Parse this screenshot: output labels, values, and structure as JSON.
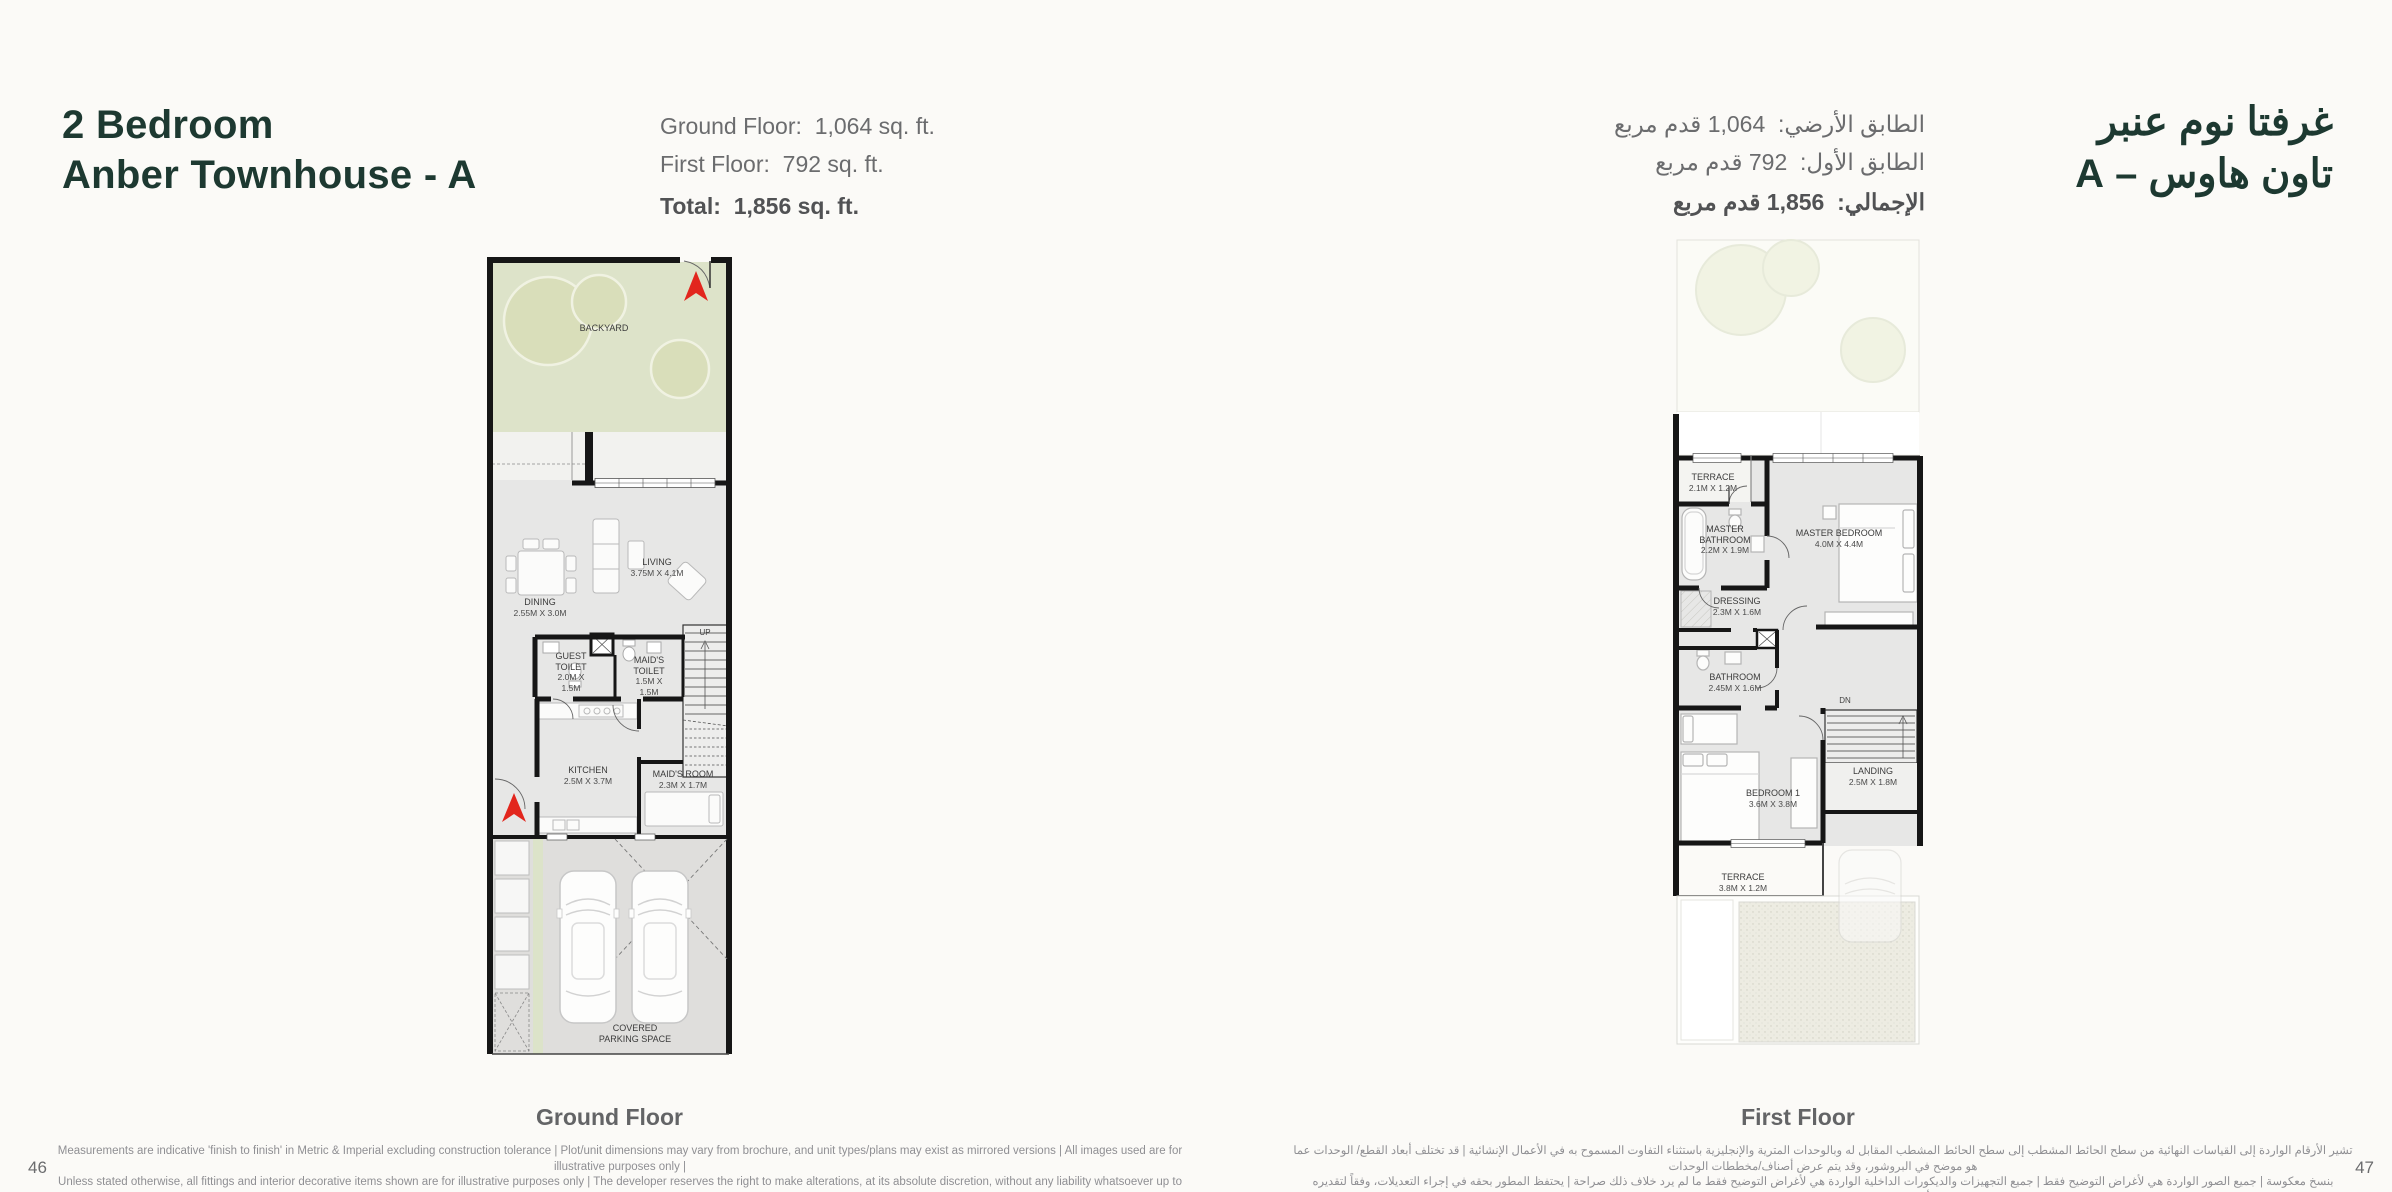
{
  "page": {
    "title_en_line1": "2 Bedroom",
    "title_en_line2": "Anber Townhouse - A",
    "title_ar_line1": "غرفتا نوم عنبر",
    "title_ar_line2": "تاون هاوس – A",
    "page_number_left": "46",
    "page_number_right": "47"
  },
  "stats_en": [
    {
      "label": "Ground Floor:",
      "value": "1,064 sq. ft."
    },
    {
      "label": "First Floor:",
      "value": "792 sq. ft."
    },
    {
      "label": "Total:",
      "value": "1,856  sq. ft."
    }
  ],
  "stats_ar": [
    {
      "label": "الطابق الأرضي:",
      "value": "1,064 قدم مربع"
    },
    {
      "label": "الطابق الأول:",
      "value": "792 قدم مربع"
    },
    {
      "label": "الإجمالي:",
      "value": "1,856 قدم مربع"
    }
  ],
  "ground": {
    "caption": "Ground Floor",
    "backyard_label": "BACKYARD",
    "stairs_label": "UP",
    "parking_label": "COVERED PARKING SPACE",
    "rooms": [
      {
        "name": "DINING",
        "dims": "2.55M X 3.0M"
      },
      {
        "name": "LIVING",
        "dims": "3.75M X 4.1M"
      },
      {
        "name": "GUEST TOILET",
        "dims": "2.0M X 1.5M"
      },
      {
        "name": "MAID'S TOILET",
        "dims": "1.5M X 1.5M"
      },
      {
        "name": "KITCHEN",
        "dims": "2.5M X 3.7M"
      },
      {
        "name": "MAID'S ROOM",
        "dims": "2.3M X 1.7M"
      }
    ]
  },
  "first": {
    "caption": "First Floor",
    "stairs_label": "DN",
    "rooms": [
      {
        "name": "TERRACE",
        "dims": "2.1M X 1.2M"
      },
      {
        "name": "MASTER BATHROOM",
        "dims": "2.2M X 1.9M"
      },
      {
        "name": "MASTER BEDROOM",
        "dims": "4.0M X 4.4M"
      },
      {
        "name": "DRESSING",
        "dims": "2.3M X 1.6M"
      },
      {
        "name": "BATHROOM",
        "dims": "2.45M X 1.6M"
      },
      {
        "name": "LANDING",
        "dims": "2.5M X 1.8M"
      },
      {
        "name": "BEDROOM 1",
        "dims": "3.6M X 3.8M"
      },
      {
        "name": "TERRACE",
        "dims": "3.8M X 1.2M"
      }
    ]
  },
  "footer": {
    "disclaimer_en_line1": "Measurements are indicative 'finish to finish' in Metric & Imperial excluding construction tolerance | Plot/unit dimensions may vary from brochure, and unit types/plans may exist as mirrored versions | All images used are for illustrative purposes only |",
    "disclaimer_en_line2": "Unless stated otherwise, all fittings and interior decorative items shown are for illustrative purposes only | The developer reserves the right to make alterations, at its absolute discretion, without any liability whatsoever up to the final 'as built' status.",
    "disclaimer_ar_line1": "تشير الأرقام الواردة إلى القياسات النهائية من سطح الحائط المشطب إلى سطح الحائط المشطب المقابل له وبالوحدات المترية والإنجليزية باستثناء التفاوت المسموح به في الأعمال الإنشائية | قد تختلف أبعاد القطع/ الوحدات عما هو موضح في البروشور، وقد يتم عرض أصناف/مخططات الوحدات",
    "disclaimer_ar_line2": "بنسخ معكوسة | جميع الصور الواردة هي لأغراض التوضيح فقط | جميع التجهيزات والديكورات الداخلية الواردة هي لأغراض التوضيح فقط ما لم يرد خلاف ذلك صراحة | يحتفظ المطور بحقه في إجراء التعديلات، وفقاً لتقديره المطلق، دون أي مسؤولية مترتبة على ذلك حتى إنجاز العمل بصورة نهائية."
  },
  "colors": {
    "brand_green": "#1d3931",
    "backyard_green": "#dde3c9",
    "arrow_red": "#e2261d",
    "interior_gray": "#e7e7e6"
  }
}
